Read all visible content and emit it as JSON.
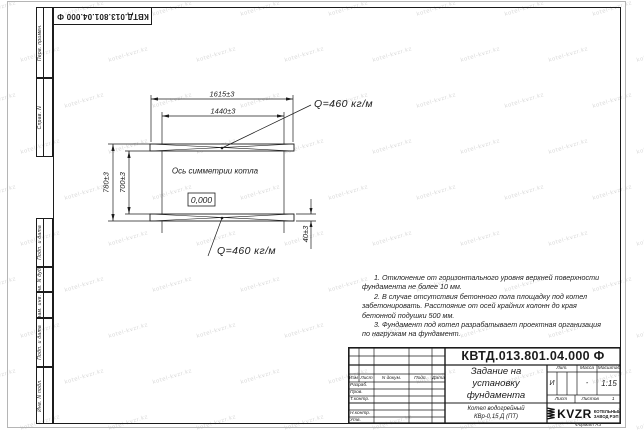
{
  "watermark": {
    "text": "kotel-kvzr.kz"
  },
  "top_stamp": {
    "doc_number_mirrored": "КВТД.013.801.04.000 Ф"
  },
  "margin": {
    "perv_primen": "Перв. примен.",
    "sprav_n": "Справ. N",
    "podp_data_upper": "Подп. и дата",
    "inv_n_dubl": "Инв. N дубл.",
    "vzam_inv_n": "Взам. инв. N",
    "podp_data_lower": "Подп. и дата",
    "inv_n_podl": "Инв. N подл."
  },
  "drawing": {
    "dim_length_outer": "1615±3",
    "dim_length_inner": "1440±3",
    "dim_height_outer": "780±3",
    "dim_height_inner": "700±3",
    "dim_rail_height": "40±3",
    "load_top": "Q=460 кг/м",
    "load_bottom": "Q=460 кг/м",
    "axis_label": "Ось симметрии котла",
    "level_mark": "0,000"
  },
  "notes": {
    "note1": "1. Отклонение от горизонтального уровня верхней поверхности фундамента не более 10 мм.",
    "note2": "2. В случае отсутствия бетонного пола площадку под котел забетонировать. Расстояние от осей крайних колонн до края бетонной подушки 500 мм.",
    "note3": "3. Фундамент под котел разрабатывает проектная организация по нагрузкам на фундамент."
  },
  "title_block": {
    "doc_number": "КВТД.013.801.04.000 Ф",
    "title_line1": "Задание на",
    "title_line2": "установку",
    "title_line3": "фундамента",
    "col_izm": "Изм",
    "col_list": "Лист",
    "col_dokum": "N докум.",
    "col_podp": "Подп.",
    "col_data": "Дата",
    "row_razrab": "Разраб.",
    "row_prov": "Пров.",
    "row_tkontr": "Т.контр.",
    "row_nkontr": "Н.контр.",
    "row_utv": "Утв.",
    "lit_header": "Лит.",
    "lit_value": "И",
    "massa_header": "Масса",
    "massa_value": "-",
    "masshtab_header": "Масштаб",
    "masshtab_value": "1:15",
    "list_label": "Лист",
    "listov_label": "Листов",
    "listov_value": "1",
    "product_line1": "Котел водогрейный",
    "product_line2": "КВр-0,15 Д (ПТ)",
    "logo_text": "KVZR",
    "company_line1": "КОТЕЛЬНЫЙ",
    "company_line2": "ЗАВОД РЭП",
    "format_note": "Формат А3"
  }
}
